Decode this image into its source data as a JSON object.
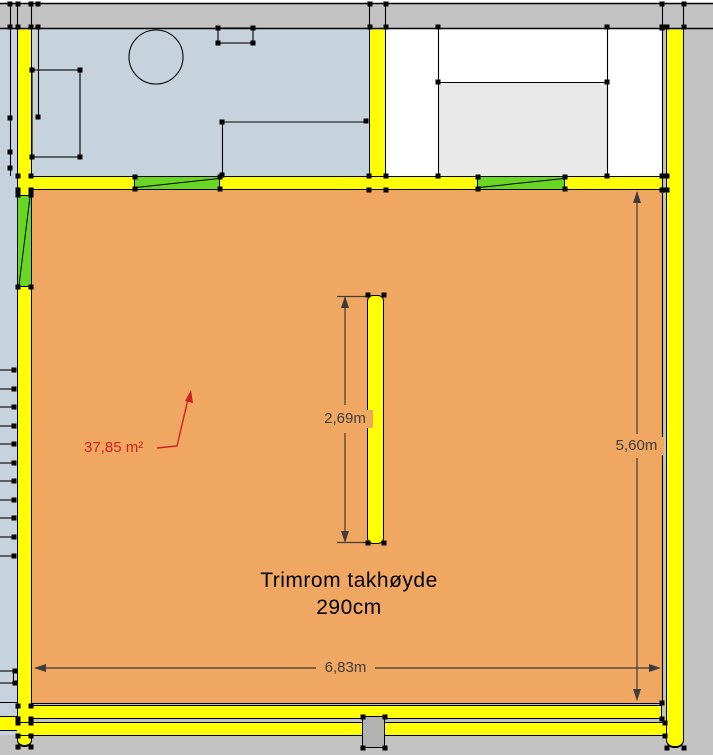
{
  "canvas": {
    "title": "floor-plan-drawing"
  },
  "colors": {
    "background_gray": "#c3c3c3",
    "room_blue": "#c6d3dd",
    "room_orange": "#f0a761",
    "wall_yellow": "#ffff00",
    "window_green": "#69d623",
    "fixture_gray": "#e9e9e9",
    "post_gray": "#b2b2b2",
    "line_black": "#000000",
    "dimension_gray": "#3d3d3d",
    "area_red": "#cc2222"
  },
  "labels": {
    "room_name_line1": "Trimrom takhøyde",
    "room_name_line2": "290cm",
    "area": "37,85 m²"
  },
  "dimensions": {
    "interior_wall_length": "2,69m",
    "room_depth": "5,60m",
    "room_width": "6,83m"
  }
}
